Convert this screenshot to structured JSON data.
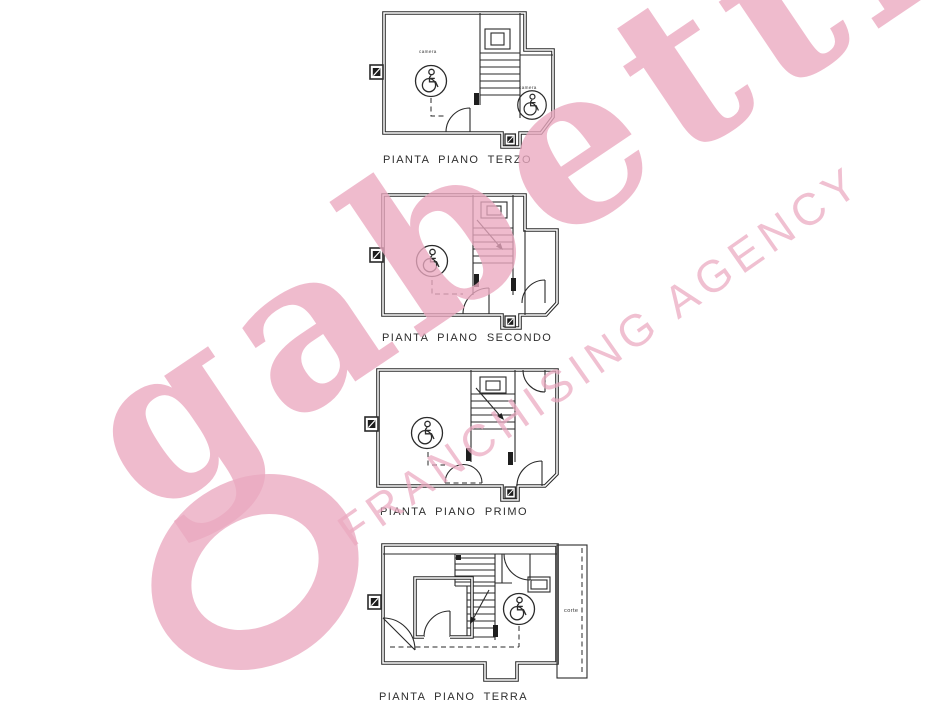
{
  "watermark": {
    "logo": "gabetti",
    "tagline": "FRANCHISING AGENCY",
    "color": "#eba9c0"
  },
  "plans": {
    "terzo": {
      "label": "PIANTA PIANO TERZO",
      "room1": "camera",
      "room2": "camera"
    },
    "secondo": {
      "label": "PIANTA PIANO SECONDO"
    },
    "primo": {
      "label": "PIANTA PIANO PRIMO"
    },
    "terra": {
      "label": "PIANTA PIANO TERRA",
      "court": "corte"
    }
  }
}
